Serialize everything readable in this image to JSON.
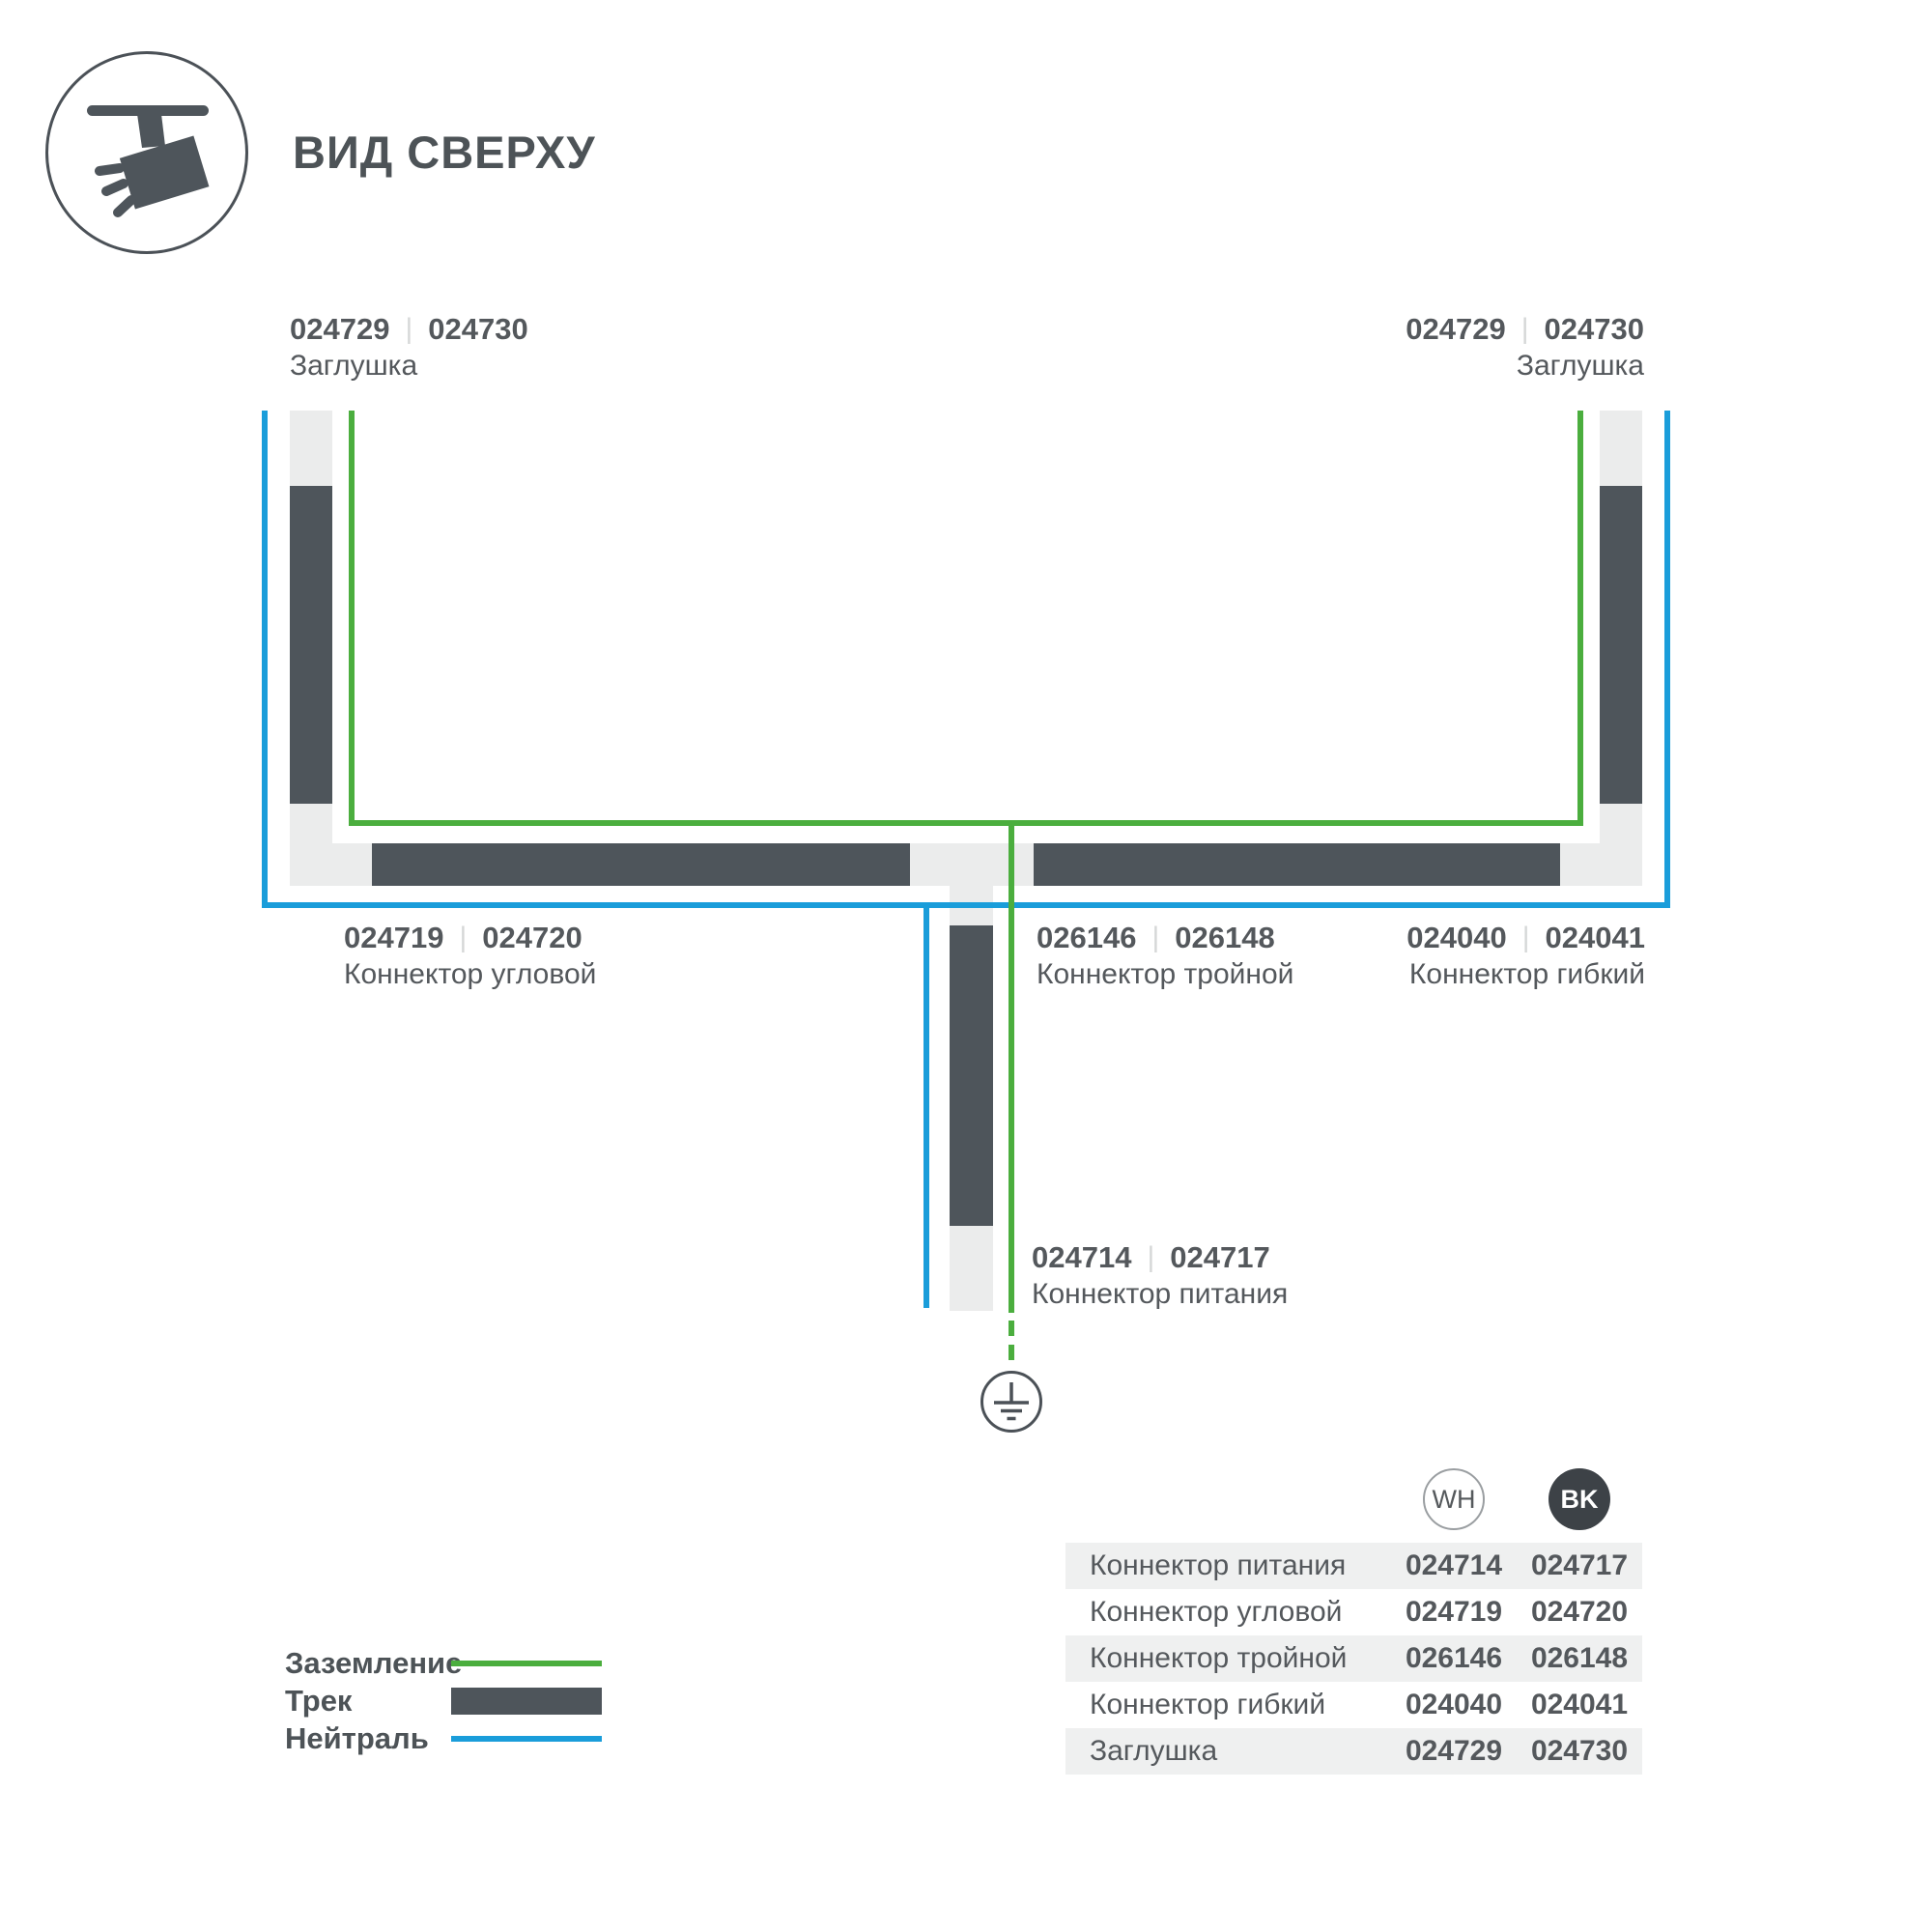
{
  "header": {
    "title": "ВИД СВЕРХУ"
  },
  "colors": {
    "ground_green": "#4bae3e",
    "neutral_blue": "#1a9dda",
    "track_dark": "#4e555b",
    "rail_light": "#ebecec",
    "row_gray": "#eff0f0",
    "separator": "#d6d8d8",
    "bk_badge": "#3d4247"
  },
  "diagram": {
    "sep": "|",
    "labels": {
      "cap_left": {
        "wh": "024729",
        "bk": "024730",
        "name": "Заглушка"
      },
      "cap_right": {
        "wh": "024729",
        "bk": "024730",
        "name": "Заглушка"
      },
      "corner": {
        "wh": "024719",
        "bk": "024720",
        "name": "Коннектор угловой"
      },
      "tee": {
        "wh": "026146",
        "bk": "026148",
        "name": "Коннектор тройной"
      },
      "flex": {
        "wh": "024040",
        "bk": "024041",
        "name": "Коннектор гибкий"
      },
      "power": {
        "wh": "024714",
        "bk": "024717",
        "name": "Коннектор питания"
      }
    }
  },
  "legend": {
    "items": [
      {
        "label": "Заземление",
        "type": "line",
        "color": "#4bae3e"
      },
      {
        "label": "Трек",
        "type": "bar",
        "color": "#4e555b"
      },
      {
        "label": "Нейтраль",
        "type": "line",
        "color": "#1a9dda"
      }
    ]
  },
  "table": {
    "col_wh": "WH",
    "col_bk": "BK",
    "rows": [
      {
        "name": "Коннектор питания",
        "wh": "024714",
        "bk": "024717"
      },
      {
        "name": "Коннектор угловой",
        "wh": "024719",
        "bk": "024720"
      },
      {
        "name": "Коннектор тройной",
        "wh": "026146",
        "bk": "026148"
      },
      {
        "name": "Коннектор гибкий",
        "wh": "024040",
        "bk": "024041"
      },
      {
        "name": "Заглушка",
        "wh": "024729",
        "bk": "024730"
      }
    ]
  }
}
